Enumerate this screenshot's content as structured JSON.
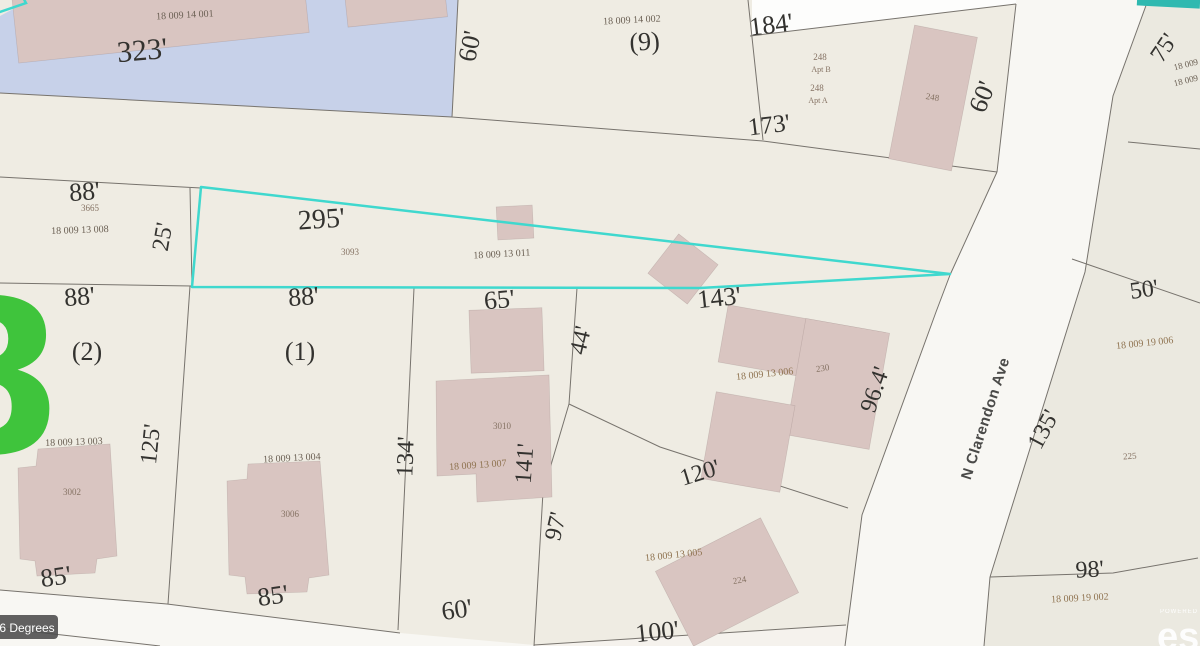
{
  "map": {
    "street_label": "N Clarendon Ave",
    "rotation_badge": "6 Degrees",
    "watermark_digit": "8",
    "attribution": {
      "powered_by": "POWERED BY",
      "brand": "esri"
    },
    "dimensions": {
      "d323": "323'",
      "d88_top": "88'",
      "d25": "25'",
      "d295": "295'",
      "d60_left": "60'",
      "d184": "184'",
      "d173": "173'",
      "d60_right": "60'",
      "d75": "75'",
      "d88_lot2": "88'",
      "d88_lot1": "88'",
      "d65": "65'",
      "d44": "44'",
      "d143": "143'",
      "d96_4": "96.4'",
      "d50": "50'",
      "d135": "135'",
      "d125": "125'",
      "d134": "134'",
      "d141": "141'",
      "d97": "97'",
      "d120": "120'",
      "d85_lot2": "85'",
      "d85_lot1": "85'",
      "d60_bottom": "60'",
      "d100": "100'",
      "d98": "98'"
    },
    "lot_numbers": {
      "lot9": "(9)",
      "lot2": "(2)",
      "lot1": "(1)"
    },
    "parcel_ids": {
      "p14001": "18 009 14 001",
      "p14002": "18 009 14 002",
      "p13008": "18 009 13 008",
      "p13011": "18 009 13 011",
      "p13003": "18 009 13 003",
      "p13004": "18 009 13 004",
      "p13007": "18 009 13 007",
      "p13006": "18 009 13 006",
      "p13005": "18 009 13 005",
      "p19006": "18 009 19 006",
      "p19002": "18 009 19 002",
      "p19_edge_a": "18 009 19",
      "p19_edge_b": "18 009 19"
    },
    "addresses": {
      "a3665": "3665",
      "a3093": "3093",
      "a248_1": "248",
      "a248_apt_b": "Apt B",
      "a248_2": "248",
      "a248_apt_a": "Apt A",
      "a248_bldg": "248",
      "a3002": "3002",
      "a3006": "3006",
      "a3010": "3010",
      "a230": "230",
      "a224": "224",
      "a225": "225"
    },
    "colors": {
      "highlight_cyan": "#3fd8ce",
      "water_blue": "#c7d1e9",
      "building_pink": "#d9c5c1",
      "parcel_beige": "#efece3",
      "road_white": "#f8f7f3",
      "teal_bar": "#2fb9b0",
      "green_digit": "#3fc43c"
    }
  }
}
